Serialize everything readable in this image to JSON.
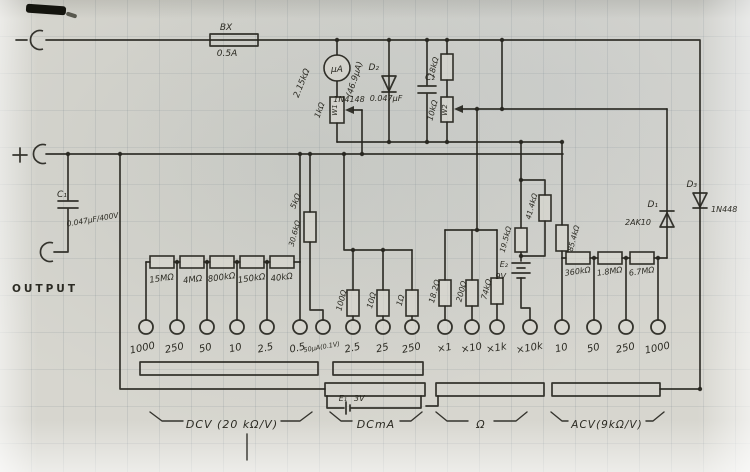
{
  "terminals": {
    "minus_jack": "−",
    "plus_jack": "+",
    "output": "OUTPUT"
  },
  "fuse": {
    "name": "BX",
    "rating": "0.5A"
  },
  "meter": {
    "unit": "μA",
    "full_scale": "(46.9μA)",
    "internal_res": "2.15kΩ"
  },
  "trimmers": {
    "w1": {
      "value": "1kΩ",
      "designator": "W1"
    },
    "w2": {
      "value": "10kΩ",
      "designator": "W2"
    }
  },
  "resistors": {
    "r18k": "18kΩ",
    "r5k": "5kΩ",
    "r30k6": "30.6kΩ",
    "r19k5": "19.5kΩ",
    "r41k4": "41.4kΩ",
    "r85k4": "85.4kΩ"
  },
  "diodes": {
    "d1": {
      "designator": "D₁",
      "part": "2AK10"
    },
    "d2": {
      "designator": "D₂",
      "part": "1N4148"
    },
    "d3": {
      "designator": "D₃",
      "part": "1N448"
    }
  },
  "capacitors": {
    "c1": {
      "designator": "C₁",
      "value": "0.047μF/400V"
    },
    "c2": {
      "designator": "C₂",
      "value": "0.047μF"
    }
  },
  "batteries": {
    "e1": {
      "designator": "E₁",
      "value": "3V"
    },
    "e2": {
      "designator": "E₂",
      "value": "9V"
    }
  },
  "dcv_section": {
    "label": "DCV (20 kΩ/V)",
    "multiplier_resistors": [
      "15MΩ",
      "4MΩ",
      "800kΩ",
      "150kΩ",
      "40kΩ"
    ],
    "range_taps": [
      "1000",
      "250",
      "50",
      "10",
      "2.5",
      "0.5"
    ]
  },
  "dcma_section": {
    "label": "DCmA",
    "shunt_resistors": [
      "100Ω",
      "10Ω",
      "1Ω"
    ],
    "range_taps": [
      "50μA(0.1V)",
      "2.5",
      "25",
      "250"
    ]
  },
  "ohm_section": {
    "label": "Ω",
    "range_resistors": [
      "18.2Ω",
      "200Ω",
      "74kΩ"
    ],
    "range_taps": [
      "×1",
      "×10",
      "×1k",
      "×10k"
    ]
  },
  "acv_section": {
    "label": "ACV(9kΩ/V)",
    "multiplier_resistors": [
      "360kΩ",
      "1.8MΩ",
      "6.7MΩ"
    ],
    "range_taps": [
      "10",
      "50",
      "250",
      "1000"
    ]
  }
}
